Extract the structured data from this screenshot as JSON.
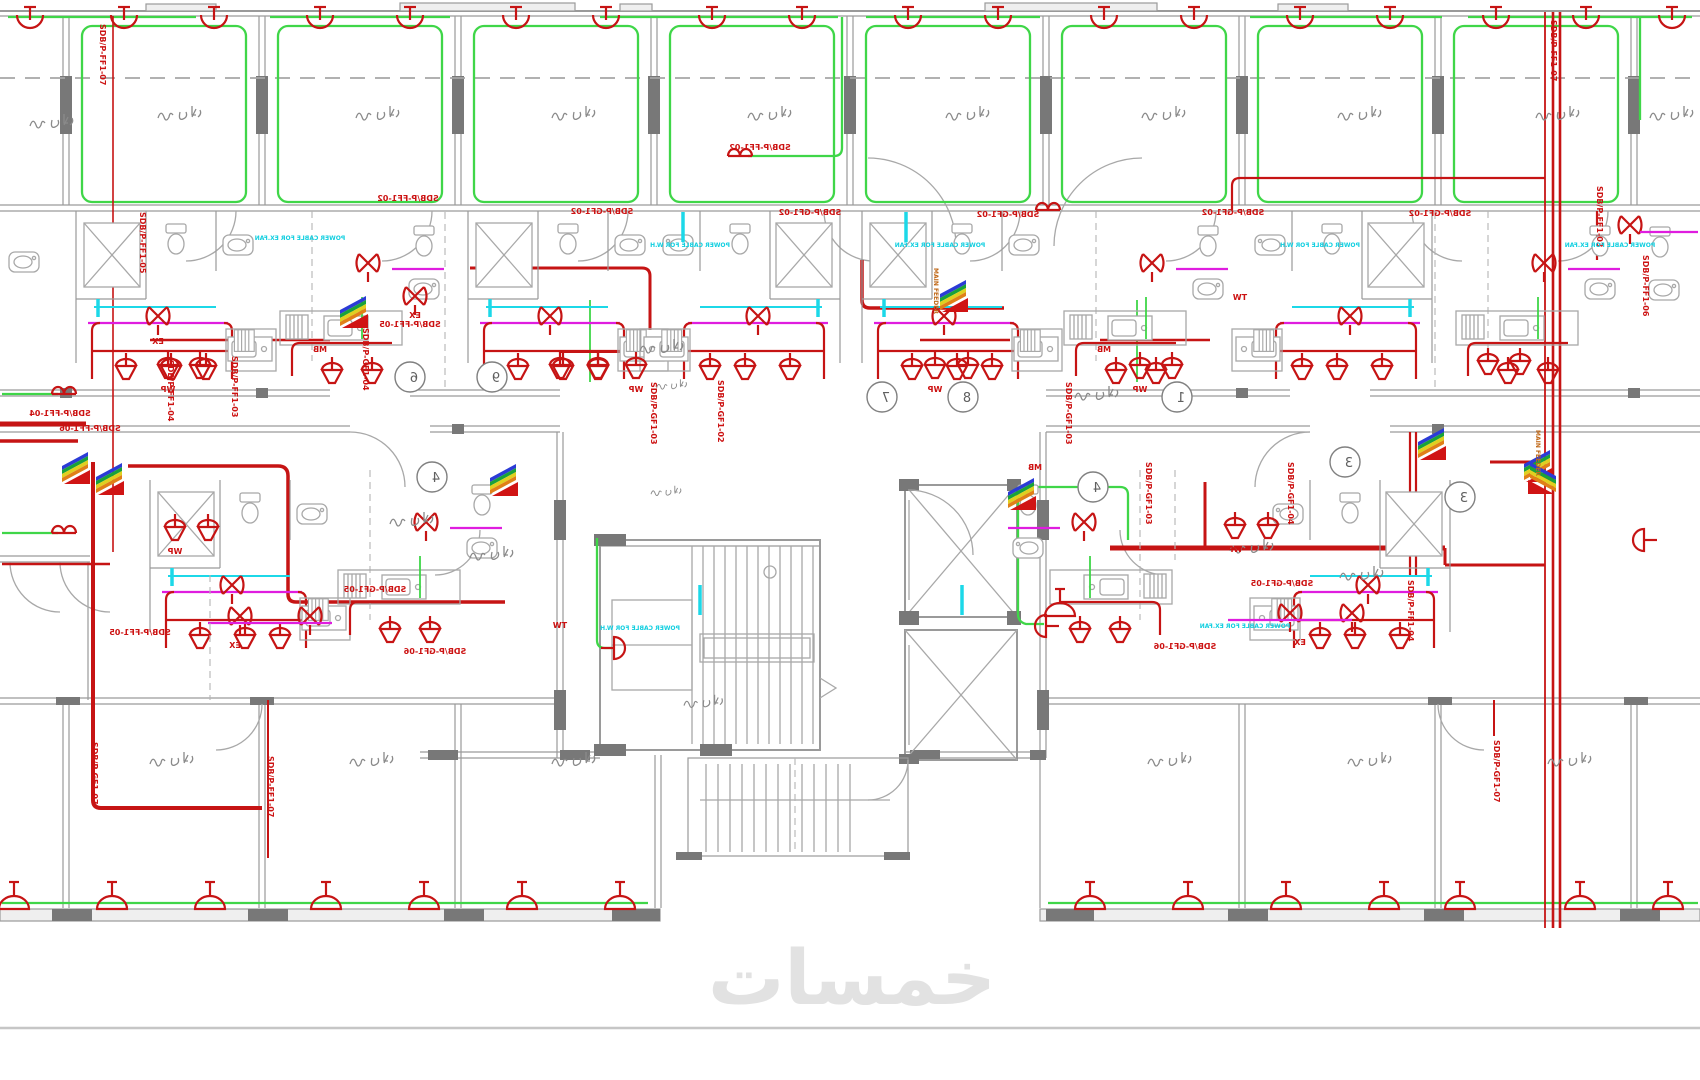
{
  "drawing": {
    "watermark": "خمسات",
    "circuit_labels": {
      "ff1_02": "SDB/P-FF1-02",
      "ff1_03": "SDB/P-FF1-03",
      "ff1_04": "SDB/P-FF1-04",
      "ff1_05": "SDB/P-FF1-05",
      "ff1_06": "SDB/P-FF1-06",
      "ff1_07": "SDB/P-FF1-07",
      "gf1_02": "SDB/P-GF1-02",
      "gf1_03": "SDB/P-GF1-03",
      "gf1_04": "SDB/P-GF1-04",
      "gf1_05": "SDB/P-GF1-05",
      "gf1_06": "SDB/P-GF1-06",
      "gf1_07": "SDB/P-GF1-07"
    },
    "device_tags": {
      "wp": "WP",
      "ex": "EX",
      "mb": "MB",
      "tw": "TW"
    },
    "notes": {
      "cable_fan": "POWER CABLE FOR EX.FAN",
      "cable_wh": "POWER CABLE FOR W.H",
      "riser": "MAIN FEEDER"
    },
    "grid_bubbles": [
      "6",
      "9",
      "7",
      "8",
      "1",
      "4",
      "4",
      "3",
      "3"
    ],
    "colors": {
      "circuit_red": "#c61414",
      "loop_green": "#3fd648",
      "annotation_magenta": "#df1ddf",
      "annotation_cyan": "#1cd8e8",
      "wall_gray": "#9a9a9a",
      "column_gray": "#787878",
      "label_red": "#cc1212",
      "riser_orange": "#c06818",
      "watermark_gray": "#e2e2e2"
    }
  }
}
